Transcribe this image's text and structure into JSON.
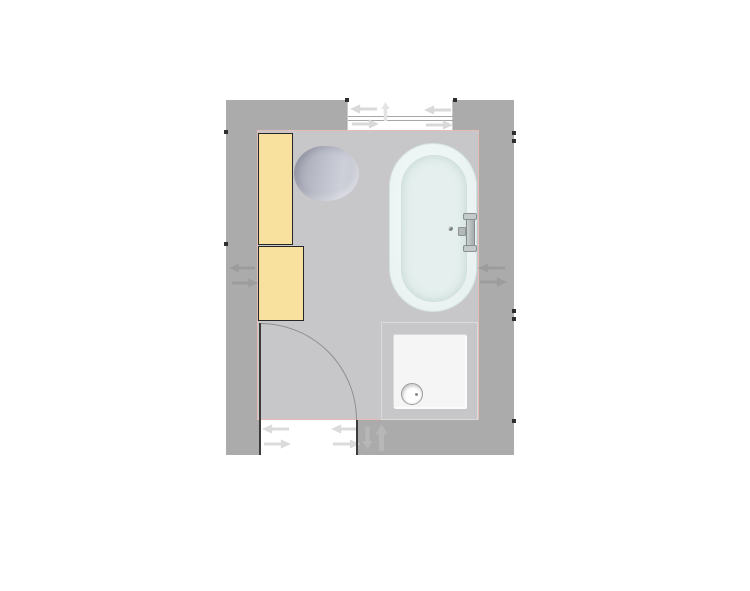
{
  "app": {
    "type": "bathroom-floor-plan",
    "visible_text": ""
  },
  "palette": {
    "background": "#FFFFFF",
    "wall": "#ABABAB",
    "floor": "#C7C7C9",
    "floor_outline": "#E5BCB6",
    "opening": "#FFFFFF",
    "cabinet_fill": "#F8E09E",
    "cabinet_border": "#262626",
    "toilet_dark": "#A4A6B2",
    "toilet_light": "#CDCFD9",
    "bathtub_fill": "#EDF5F4",
    "bathtub_inner": "#E5F0EE",
    "shower_fill": "#F1F1F1",
    "drain_border": "#9A9A9A",
    "door_arc": "#8F8F8F",
    "door_leaf": "#3B3B3B",
    "arrow_window": "#D9D9D9",
    "arrow_wall": "#9C9C9C",
    "arrow_swing": "#B7B7B7",
    "tick": "#2E2E2E"
  },
  "room": {
    "outer": {
      "left": 226,
      "top": 100,
      "width": 288,
      "height": 355,
      "fill": "#ABABAB"
    },
    "floor": {
      "left": 31,
      "top": 30,
      "width": 222,
      "height": 290,
      "fill": "#C7C7C9"
    }
  },
  "openings": {
    "window": {
      "rect": {
        "left": 121,
        "top": 0,
        "width": 106,
        "height": 30,
        "fill": "#FFFFFF"
      },
      "glass": {
        "left": 0,
        "top": 16,
        "width": 106,
        "height": 5
      },
      "arrow_left_1": {
        "left": 2,
        "top": 4,
        "width": 27,
        "height": 10
      },
      "arrow_right_1": {
        "left": 4,
        "top": 19,
        "width": 27,
        "height": 10
      },
      "arrow_up": {
        "left": 29,
        "top": 2,
        "width": 17,
        "height": 19
      },
      "arrow_left_2": {
        "left": 76,
        "top": 5,
        "width": 27,
        "height": 10
      },
      "arrow_right_2": {
        "left": 78,
        "top": 20,
        "width": 27,
        "height": 10
      }
    },
    "door": {
      "rect": {
        "left": 34,
        "top": 320,
        "width": 97,
        "height": 35,
        "fill": "#FFFFFF"
      },
      "arrow_left_1": {
        "left": 2,
        "top": 4,
        "width": 27,
        "height": 10
      },
      "arrow_right_1": {
        "left": 4,
        "top": 19,
        "width": 27,
        "height": 10
      },
      "arrow_left_2": {
        "left": 71,
        "top": 4,
        "width": 27,
        "height": 10
      },
      "arrow_right_2": {
        "left": 73,
        "top": 19,
        "width": 27,
        "height": 10
      },
      "leaf": {
        "left": 33,
        "top": 223,
        "width": 2,
        "height": 132,
        "fill": "#3B3B3B"
      },
      "jamb": {
        "left": 130,
        "top": 320,
        "width": 2,
        "height": 35,
        "fill": "#3B3B3B"
      },
      "arc": {
        "left": 34,
        "top": 223,
        "width": 97,
        "height": 97
      },
      "swing_down": {
        "left": 136,
        "top": 325,
        "width": 11,
        "height": 26
      },
      "swing_up": {
        "left": 149,
        "top": 324,
        "width": 13,
        "height": 27
      }
    }
  },
  "fixtures": {
    "cabinet_tall": {
      "rect": {
        "left": 32,
        "top": 33,
        "width": 35,
        "height": 112,
        "fill": "#F8E09E"
      }
    },
    "cabinet_low": {
      "rect": {
        "left": 32,
        "top": 146,
        "width": 46,
        "height": 75,
        "fill": "#F8E09E"
      }
    },
    "toilet": {
      "rect": {
        "left": 68,
        "top": 46,
        "width": 65,
        "height": 55
      }
    },
    "bathtub": {
      "rect": {
        "left": 163,
        "top": 43,
        "width": 88,
        "height": 169
      },
      "inner": {
        "left": 11,
        "top": 11,
        "width": 66,
        "height": 147
      },
      "faucet": {
        "left": 57,
        "top": 68,
        "width": 32,
        "height": 42
      }
    },
    "shower": {
      "rect": {
        "left": 155,
        "top": 222,
        "width": 97,
        "height": 98
      },
      "inner": {
        "left": 11,
        "top": 11,
        "width": 73,
        "height": 74
      },
      "drain": {
        "left": 19,
        "top": 60,
        "width": 22,
        "height": 22
      }
    }
  },
  "controls": {
    "wall_left_arrow_left": {
      "left": 3,
      "top": 163,
      "width": 26,
      "height": 10
    },
    "wall_left_arrow_right": {
      "left": 6,
      "top": 178,
      "width": 26,
      "height": 10
    },
    "wall_right_arrow_left": {
      "left": 252,
      "top": 163,
      "width": 27,
      "height": 10
    },
    "wall_right_arrow_right": {
      "left": 254,
      "top": 177,
      "width": 27,
      "height": 10
    }
  },
  "ticks": [
    {
      "left": -2,
      "top": 30,
      "width": 4,
      "height": 4,
      "fill": "#2E2E2E"
    },
    {
      "left": -2,
      "top": 142,
      "width": 4,
      "height": 4,
      "fill": "#2E2E2E"
    },
    {
      "left": 286,
      "top": 31,
      "width": 4,
      "height": 4,
      "fill": "#2E2E2E"
    },
    {
      "left": 286,
      "top": 39,
      "width": 4,
      "height": 4,
      "fill": "#2E2E2E"
    },
    {
      "left": 286,
      "top": 209,
      "width": 4,
      "height": 4,
      "fill": "#2E2E2E"
    },
    {
      "left": 286,
      "top": 217,
      "width": 4,
      "height": 4,
      "fill": "#2E2E2E"
    },
    {
      "left": 286,
      "top": 319,
      "width": 4,
      "height": 4,
      "fill": "#2E2E2E"
    },
    {
      "left": 119,
      "top": -2,
      "width": 4,
      "height": 4,
      "fill": "#2E2E2E"
    },
    {
      "left": 227,
      "top": -2,
      "width": 4,
      "height": 4,
      "fill": "#2E2E2E"
    }
  ]
}
